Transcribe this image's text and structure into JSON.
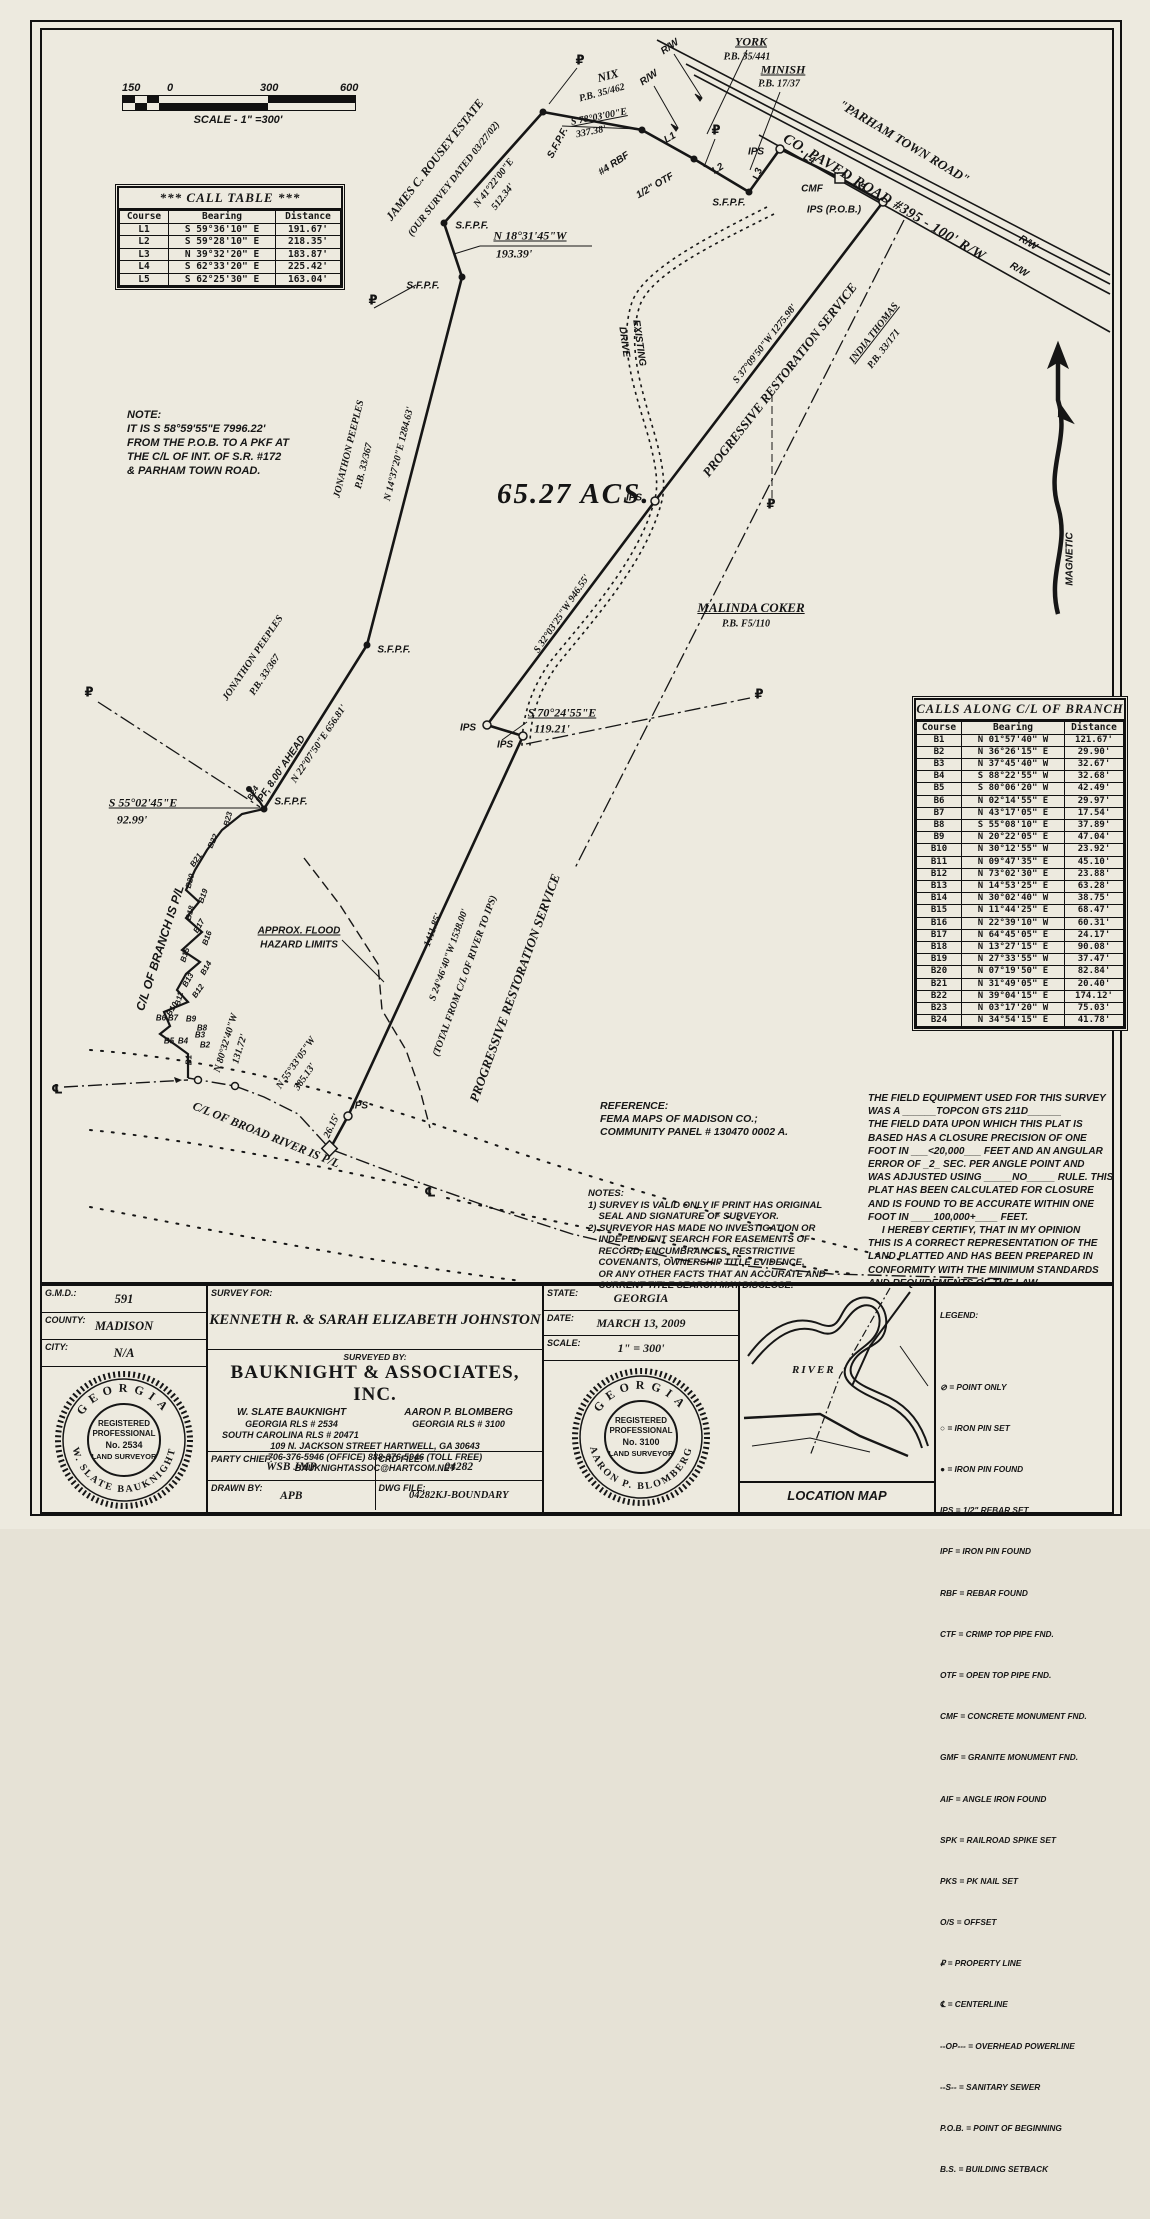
{
  "scale_bar": {
    "ticks": [
      "150",
      "0",
      "300",
      "600"
    ],
    "label": "SCALE - 1\" =300'"
  },
  "call_table": {
    "title": "*** CALL TABLE ***",
    "headers": [
      "Course",
      "Bearing",
      "Distance"
    ],
    "rows": [
      [
        "L1",
        "S 59°36'10\" E",
        "191.67'"
      ],
      [
        "L2",
        "S 59°28'10\" E",
        "218.35'"
      ],
      [
        "L3",
        "N 39°32'20\" E",
        "183.87'"
      ],
      [
        "L4",
        "S 62°33'20\" E",
        "225.42'"
      ],
      [
        "L5",
        "S 62°25'30\" E",
        "163.04'"
      ]
    ]
  },
  "branch_table": {
    "title": "CALLS ALONG C/L OF BRANCH",
    "headers": [
      "Course",
      "Bearing",
      "Distance"
    ],
    "rows": [
      [
        "B1",
        "N 01°57'40\" W",
        "121.67'"
      ],
      [
        "B2",
        "N 36°26'15\" E",
        "29.90'"
      ],
      [
        "B3",
        "N 37°45'40\" W",
        "32.67'"
      ],
      [
        "B4",
        "S 88°22'55\" W",
        "32.68'"
      ],
      [
        "B5",
        "S 80°06'20\" W",
        "42.49'"
      ],
      [
        "B6",
        "N 02°14'55\" E",
        "29.97'"
      ],
      [
        "B7",
        "N 43°17'05\" E",
        "17.54'"
      ],
      [
        "B8",
        "S 55°08'10\" E",
        "37.89'"
      ],
      [
        "B9",
        "N 20°22'05\" E",
        "47.04'"
      ],
      [
        "B10",
        "N 30°12'55\" W",
        "23.92'"
      ],
      [
        "B11",
        "N 09°47'35\" E",
        "45.10'"
      ],
      [
        "B12",
        "N 73°02'30\" E",
        "23.88'"
      ],
      [
        "B13",
        "N 14°53'25\" E",
        "63.28'"
      ],
      [
        "B14",
        "N 30°02'40\" W",
        "38.75'"
      ],
      [
        "B15",
        "N 11°44'25\" E",
        "68.47'"
      ],
      [
        "B16",
        "N 22°39'10\" W",
        "60.31'"
      ],
      [
        "B17",
        "N 64°45'05\" E",
        "24.17'"
      ],
      [
        "B18",
        "N 13°27'15\" E",
        "90.08'"
      ],
      [
        "B19",
        "N 27°33'55\" W",
        "37.47'"
      ],
      [
        "B20",
        "N 07°19'50\" E",
        "82.84'"
      ],
      [
        "B21",
        "N 31°49'05\" E",
        "20.40'"
      ],
      [
        "B22",
        "N 39°04'15\" E",
        "174.12'"
      ],
      [
        "B23",
        "N 03°17'20\" W",
        "75.03'"
      ],
      [
        "B24",
        "N 34°54'15\" E",
        "41.78'"
      ]
    ]
  },
  "note_box": [
    "NOTE:",
    "IT IS S 58°59'55\"E 7996.22'",
    "FROM THE P.O.B. TO A PKF AT",
    "THE C/L OF INT. OF S.R. #172",
    "& PARHAM TOWN ROAD."
  ],
  "reference": [
    "REFERENCE:",
    "FEMA MAPS OF MADISON CO.;",
    "COMMUNITY PANEL # 130470 0002 A."
  ],
  "survey_notes": [
    "NOTES:",
    "1) SURVEY IS VALID ONLY IF PRINT HAS ORIGINAL",
    "    SEAL AND SIGNATURE OF SURVEYOR.",
    "2) SURVEYOR HAS MADE NO INVESTIGATION OR",
    "    INDEPENDENT SEARCH FOR EASEMENTS OF",
    "    RECORD, ENCUMBRANCES, RESTRICTIVE",
    "    COVENANTS, OWNERSHIP TITLE EVIDENCE,",
    "    OR ANY OTHER FACTS THAT AN ACCURATE AND",
    "    CURRENT TITLE SEARCH MAY DISCLOSE."
  ],
  "certification": [
    "THE FIELD EQUIPMENT USED FOR THIS SURVEY",
    "WAS A ______TOPCON GTS 211D______",
    "THE FIELD DATA UPON WHICH THIS PLAT IS",
    "BASED HAS A CLOSURE PRECISION OF ONE",
    "FOOT IN ___<20,000___ FEET AND AN ANGULAR",
    "ERROR OF _2_ SEC. PER ANGLE POINT AND",
    "WAS ADJUSTED USING _____NO_____ RULE. THIS",
    "PLAT HAS BEEN CALCULATED FOR CLOSURE",
    "AND IS FOUND TO BE ACCURATE WITHIN ONE",
    "FOOT IN ____100,000+____ FEET.",
    "     I HEREBY CERTIFY, THAT IN MY OPINION",
    "THIS IS A CORRECT REPRESENTATION OF THE",
    "LAND PLATTED AND HAS BEEN PREPARED IN",
    "CONFORMITY WITH THE MINIMUM STANDARDS",
    "AND REQUIREMENTS OF THE LAW."
  ],
  "plat": {
    "acreage": "65.27 ACS.",
    "labels": [
      {
        "t": "R/W",
        "x": 668,
        "y": 45,
        "r": -35
      },
      {
        "t": "R/W",
        "x": 647,
        "y": 76,
        "r": -35
      },
      {
        "t": "YORK",
        "x": 749,
        "y": 40,
        "r": 0,
        "c": "ser u s12"
      },
      {
        "t": "P.B. 35/441",
        "x": 745,
        "y": 55,
        "r": 0,
        "c": "ser"
      },
      {
        "t": "MINISH",
        "x": 781,
        "y": 68,
        "r": 0,
        "c": "ser u s12"
      },
      {
        "t": "P.B. 17/37",
        "x": 777,
        "y": 82,
        "r": 0,
        "c": "ser"
      },
      {
        "t": "NIX",
        "x": 606,
        "y": 74,
        "r": -15,
        "c": "ser s12"
      },
      {
        "t": "P.B. 35/462",
        "x": 600,
        "y": 91,
        "r": -15,
        "c": "ser"
      },
      {
        "t": "\"PARHAM TOWN ROAD\"",
        "x": 902,
        "y": 140,
        "r": 31,
        "c": "ser s13"
      },
      {
        "t": "CO. PAVED ROAD #395 - 100' R/W",
        "x": 882,
        "y": 196,
        "r": 31,
        "c": "ser s14"
      },
      {
        "t": "R/W",
        "x": 1026,
        "y": 241,
        "r": 31
      },
      {
        "t": "R/W",
        "x": 1017,
        "y": 268,
        "r": 31
      },
      {
        "t": "S 78°03'00\"E",
        "x": 597,
        "y": 115,
        "r": -11,
        "c": "ser u"
      },
      {
        "t": "337.38'",
        "x": 589,
        "y": 130,
        "r": -11,
        "c": "ser"
      },
      {
        "t": "S.F.P.F.",
        "x": 556,
        "y": 141,
        "r": -62
      },
      {
        "t": "#4 RBF",
        "x": 612,
        "y": 162,
        "r": -33
      },
      {
        "t": "L1",
        "x": 668,
        "y": 136,
        "r": -30
      },
      {
        "t": "1/2\" OTF",
        "x": 653,
        "y": 184,
        "r": -30
      },
      {
        "t": "L2",
        "x": 716,
        "y": 167,
        "r": -33
      },
      {
        "t": "S.F.P.F.",
        "x": 727,
        "y": 201,
        "r": 0
      },
      {
        "t": "L3",
        "x": 756,
        "y": 172,
        "r": -72
      },
      {
        "t": "IPS",
        "x": 754,
        "y": 150,
        "r": 0
      },
      {
        "t": "L4",
        "x": 807,
        "y": 157,
        "r": 28
      },
      {
        "t": "CMF",
        "x": 810,
        "y": 187,
        "r": 0
      },
      {
        "t": "L5",
        "x": 857,
        "y": 184,
        "r": 28
      },
      {
        "t": "IPS (P.O.B.)",
        "x": 832,
        "y": 208,
        "r": 0
      },
      {
        "t": "₽",
        "x": 578,
        "y": 59,
        "r": 0,
        "c": "sym"
      },
      {
        "t": "₽",
        "x": 371,
        "y": 299,
        "r": 0,
        "c": "sym"
      },
      {
        "t": "₽",
        "x": 714,
        "y": 129,
        "r": 0,
        "c": "sym"
      },
      {
        "t": "JAMES C. ROUSEY ESTATE",
        "x": 433,
        "y": 158,
        "r": -52,
        "c": "ser s12"
      },
      {
        "t": "(OUR SURVEY DATED 03/27/02)",
        "x": 452,
        "y": 177,
        "r": -52,
        "c": "ser"
      },
      {
        "t": "N 41°22'00\"E",
        "x": 492,
        "y": 181,
        "r": -52,
        "c": "ser"
      },
      {
        "t": "512.34'",
        "x": 501,
        "y": 195,
        "r": -52,
        "c": "ser"
      },
      {
        "t": "S.F.P.F.",
        "x": 470,
        "y": 224,
        "r": 0
      },
      {
        "t": "N 18°31'45\"W",
        "x": 528,
        "y": 234,
        "r": 0,
        "c": "ser u s12"
      },
      {
        "t": "193.39'",
        "x": 512,
        "y": 252,
        "r": 0,
        "c": "ser s12"
      },
      {
        "t": "S.F.P.F.",
        "x": 421,
        "y": 284,
        "r": 0
      },
      {
        "t": "JONATHON PEEPLES",
        "x": 347,
        "y": 447,
        "r": -76,
        "c": "ser"
      },
      {
        "t": "P.B. 33/367",
        "x": 362,
        "y": 464,
        "r": -76,
        "c": "ser"
      },
      {
        "t": "N 14°37'20\"E 1284.63'",
        "x": 397,
        "y": 452,
        "r": -76,
        "c": "ser"
      },
      {
        "t": "EXISTING",
        "x": 637,
        "y": 341,
        "r": 82
      },
      {
        "t": "DRIVE",
        "x": 622,
        "y": 340,
        "r": 82
      },
      {
        "t": "S 37°09'50\"W 1275.98'",
        "x": 763,
        "y": 342,
        "r": -52,
        "c": "ser"
      },
      {
        "t": "PROGRESSIVE RESTORATION SERVICE",
        "x": 778,
        "y": 378,
        "r": -52,
        "c": "ser s13"
      },
      {
        "t": "INDIA THOMAS",
        "x": 872,
        "y": 331,
        "r": -52,
        "c": "ser u"
      },
      {
        "t": "P.B. 33/171",
        "x": 882,
        "y": 347,
        "r": -52,
        "c": "ser"
      },
      {
        "t": "IPS",
        "x": 632,
        "y": 496,
        "r": 0
      },
      {
        "t": "₽",
        "x": 769,
        "y": 503,
        "r": 0,
        "c": "sym"
      },
      {
        "t": "MALINDA COKER",
        "x": 749,
        "y": 606,
        "r": 0,
        "c": "ser u s13"
      },
      {
        "t": "P.B. F5/110",
        "x": 744,
        "y": 622,
        "r": 0,
        "c": "ser"
      },
      {
        "t": "S 32°03'25\"W 946.55'",
        "x": 560,
        "y": 612,
        "r": -56,
        "c": "ser"
      },
      {
        "t": "JONATHON PEEPLES",
        "x": 251,
        "y": 656,
        "r": -56,
        "c": "ser"
      },
      {
        "t": "P.B. 33/367",
        "x": 263,
        "y": 673,
        "r": -56,
        "c": "ser"
      },
      {
        "t": "IPF, 8.00' AHEAD",
        "x": 279,
        "y": 768,
        "r": -56
      },
      {
        "t": "N 22°07'50\"E 656.81'",
        "x": 317,
        "y": 742,
        "r": -56,
        "c": "ser"
      },
      {
        "t": "S.F.P.F.",
        "x": 392,
        "y": 648,
        "r": 0
      },
      {
        "t": "IPS",
        "x": 466,
        "y": 726,
        "r": 0
      },
      {
        "t": "IPS",
        "x": 503,
        "y": 743,
        "r": 0
      },
      {
        "t": "S 70°24'55\"E",
        "x": 560,
        "y": 711,
        "r": 0,
        "c": "ser u s12"
      },
      {
        "t": "119.21'",
        "x": 550,
        "y": 727,
        "r": 0,
        "c": "ser s12"
      },
      {
        "t": "₽",
        "x": 757,
        "y": 693,
        "r": 0,
        "c": "sym"
      },
      {
        "t": "₽",
        "x": 87,
        "y": 691,
        "r": 0,
        "c": "sym"
      },
      {
        "t": "S 55°02'45\"E",
        "x": 141,
        "y": 801,
        "r": 0,
        "c": "ser u s12"
      },
      {
        "t": "92.99'",
        "x": 130,
        "y": 818,
        "r": 0,
        "c": "ser s12"
      },
      {
        "t": "S.F.P.F.",
        "x": 289,
        "y": 800,
        "r": 0
      },
      {
        "t": "C/L OF BRANCH IS P/L",
        "x": 158,
        "y": 946,
        "r": -72,
        "c": "s12"
      },
      {
        "t": "APPROX. FLOOD",
        "x": 297,
        "y": 929,
        "r": 0,
        "c": "u"
      },
      {
        "t": "HAZARD LIMITS",
        "x": 297,
        "y": 943,
        "r": 0
      },
      {
        "t": "B24",
        "x": 251,
        "y": 791,
        "r": -60,
        "c": "s8"
      },
      {
        "t": "B23",
        "x": 226,
        "y": 817,
        "r": -75,
        "c": "s8"
      },
      {
        "t": "B22",
        "x": 211,
        "y": 839,
        "r": -65,
        "c": "s8"
      },
      {
        "t": "B21",
        "x": 194,
        "y": 858,
        "r": -55,
        "c": "s8"
      },
      {
        "t": "B20",
        "x": 188,
        "y": 879,
        "r": -75,
        "c": "s8"
      },
      {
        "t": "B19",
        "x": 201,
        "y": 894,
        "r": -70,
        "c": "s8"
      },
      {
        "t": "B18",
        "x": 188,
        "y": 911,
        "r": -75,
        "c": "s8"
      },
      {
        "t": "B17",
        "x": 197,
        "y": 924,
        "r": -60,
        "c": "s8"
      },
      {
        "t": "B16",
        "x": 205,
        "y": 936,
        "r": -70,
        "c": "s8"
      },
      {
        "t": "B15",
        "x": 183,
        "y": 953,
        "r": -72,
        "c": "s8"
      },
      {
        "t": "B14",
        "x": 204,
        "y": 966,
        "r": -60,
        "c": "s8"
      },
      {
        "t": "B13",
        "x": 186,
        "y": 978,
        "r": -60,
        "c": "s8"
      },
      {
        "t": "B12",
        "x": 196,
        "y": 989,
        "r": -55,
        "c": "s8"
      },
      {
        "t": "B11",
        "x": 177,
        "y": 997,
        "r": -75,
        "c": "s8"
      },
      {
        "t": "B10",
        "x": 170,
        "y": 1007,
        "r": -60,
        "c": "s8"
      },
      {
        "t": "B9",
        "x": 189,
        "y": 1017,
        "r": 0,
        "c": "s8"
      },
      {
        "t": "B8",
        "x": 200,
        "y": 1026,
        "r": 0,
        "c": "s8"
      },
      {
        "t": "B7",
        "x": 171,
        "y": 1016,
        "r": 0,
        "c": "s8"
      },
      {
        "t": "B6",
        "x": 159,
        "y": 1016,
        "r": 0,
        "c": "s8"
      },
      {
        "t": "B5",
        "x": 167,
        "y": 1039,
        "r": 0,
        "c": "s8"
      },
      {
        "t": "B4",
        "x": 181,
        "y": 1039,
        "r": 0,
        "c": "s8"
      },
      {
        "t": "B3",
        "x": 198,
        "y": 1033,
        "r": 0,
        "c": "s8"
      },
      {
        "t": "B2",
        "x": 203,
        "y": 1043,
        "r": 0,
        "c": "s8"
      },
      {
        "t": "B1",
        "x": 187,
        "y": 1058,
        "r": -90,
        "c": "s8"
      },
      {
        "t": "N 80°32'40\"W",
        "x": 224,
        "y": 1041,
        "r": -73,
        "c": "ser"
      },
      {
        "t": "131.72'",
        "x": 238,
        "y": 1047,
        "r": -73,
        "c": "ser"
      },
      {
        "t": "N 55°33'05\"W",
        "x": 294,
        "y": 1061,
        "r": -55,
        "c": "ser"
      },
      {
        "t": "385.13'",
        "x": 303,
        "y": 1075,
        "r": -55,
        "c": "ser"
      },
      {
        "t": "C/L OF BROAD RIVER IS P/L",
        "x": 264,
        "y": 1133,
        "r": 22,
        "c": "ser s12"
      },
      {
        "t": "26.15'",
        "x": 330,
        "y": 1124,
        "r": -65,
        "c": "ser"
      },
      {
        "t": "IPS",
        "x": 358,
        "y": 1104,
        "r": 0
      },
      {
        "t": "1411.85'",
        "x": 431,
        "y": 928,
        "r": -70,
        "c": "ser"
      },
      {
        "t": "S 24°46'40\"W 1538.00'",
        "x": 447,
        "y": 953,
        "r": -70,
        "c": "ser"
      },
      {
        "t": "(TOTAL FROM C/L OF RIVER TO IPS)",
        "x": 463,
        "y": 974,
        "r": -70,
        "c": "ser"
      },
      {
        "t": "PROGRESSIVE RESTORATION SERVICE",
        "x": 513,
        "y": 986,
        "r": -70,
        "c": "ser s13"
      },
      {
        "t": "℄",
        "x": 55,
        "y": 1088,
        "r": 0,
        "c": "sym"
      },
      {
        "t": "℄",
        "x": 428,
        "y": 1191,
        "r": 0,
        "c": "sym"
      },
      {
        "t": "MAGNETIC",
        "x": 1068,
        "y": 557,
        "r": -90
      }
    ]
  },
  "title_block": {
    "gmd_label": "G.M.D.:",
    "gmd": "591",
    "county_label": "COUNTY:",
    "county": "MADISON",
    "city_label": "CITY:",
    "city": "N/A",
    "survey_for_label": "SURVEY FOR:",
    "survey_for": "KENNETH R. & SARAH ELIZABETH JOHNSTON",
    "surveyed_by_label": "SURVEYED BY:",
    "firm": "BAUKNIGHT & ASSOCIATES, INC.",
    "name1": "W. SLATE BAUKNIGHT",
    "name2": "AARON P. BLOMBERG",
    "rls1": "GEORGIA RLS # 2534",
    "rls2": "GEORGIA RLS # 3100",
    "rls3": "SOUTH CAROLINA RLS # 20471",
    "address": "109 N. JACKSON STREET   HARTWELL, GA   30643",
    "phones": "706-376-5946 (OFFICE)    888-376-5946 (TOLL FREE)",
    "email": "BAUKNIGHTASSOC@HARTCOM.NET",
    "party_chief_label": "PARTY CHIEF:",
    "party_chief": "WSB JMP",
    "crd_file_label": "CRD FILE:",
    "crd_file": "04282",
    "drawn_by_label": "DRAWN BY:",
    "drawn_by": "APB",
    "dwg_file_label": "DWG FILE:",
    "dwg_file": "04282KJ-BOUNDARY",
    "state_label": "STATE:",
    "state": "GEORGIA",
    "date_label": "DATE:",
    "date": "MARCH 13, 2009",
    "scale_label": "SCALE:",
    "scale": "1\" = 300'"
  },
  "seals": [
    {
      "state": "GEORGIA",
      "name": "W. SLATE BAUKNIGHT",
      "l1": "REGISTERED",
      "l2": "PROFESSIONAL",
      "no": "No. 2534",
      "l3": "LAND SURVEYOR"
    },
    {
      "state": "GEORGIA",
      "name": "AARON P. BLOMBERG",
      "l1": "REGISTERED",
      "l2": "PROFESSIONAL",
      "no": "No. 3100",
      "l3": "LAND SURVEYOR"
    }
  ],
  "location_map": {
    "river_label": "RIVER",
    "caption": "LOCATION MAP"
  },
  "legend": {
    "title": "LEGEND:",
    "items": [
      "⊘ = POINT ONLY",
      "○ = IRON PIN SET",
      "● = IRON PIN FOUND",
      "IPS = 1/2\" REBAR SET",
      "IPF = IRON PIN FOUND",
      "RBF = REBAR FOUND",
      "CTF = CRIMP TOP PIPE FND.",
      "OTF = OPEN TOP PIPE FND.",
      "CMF = CONCRETE MONUMENT FND.",
      "GMF = GRANITE MONUMENT FND.",
      "AIF = ANGLE IRON FOUND",
      "SPK = RAILROAD SPIKE SET",
      "PKS = PK NAIL SET",
      "O/S = OFFSET",
      "₽ = PROPERTY LINE",
      "℄ = CENTERLINE",
      "--OP--- = OVERHEAD POWERLINE",
      "--S-- = SANITARY SEWER",
      "P.O.B. = POINT OF BEGINNING",
      "B.S. = BUILDING SETBACK"
    ]
  },
  "colors": {
    "ink": "#161616",
    "paper": "#edeadf"
  }
}
